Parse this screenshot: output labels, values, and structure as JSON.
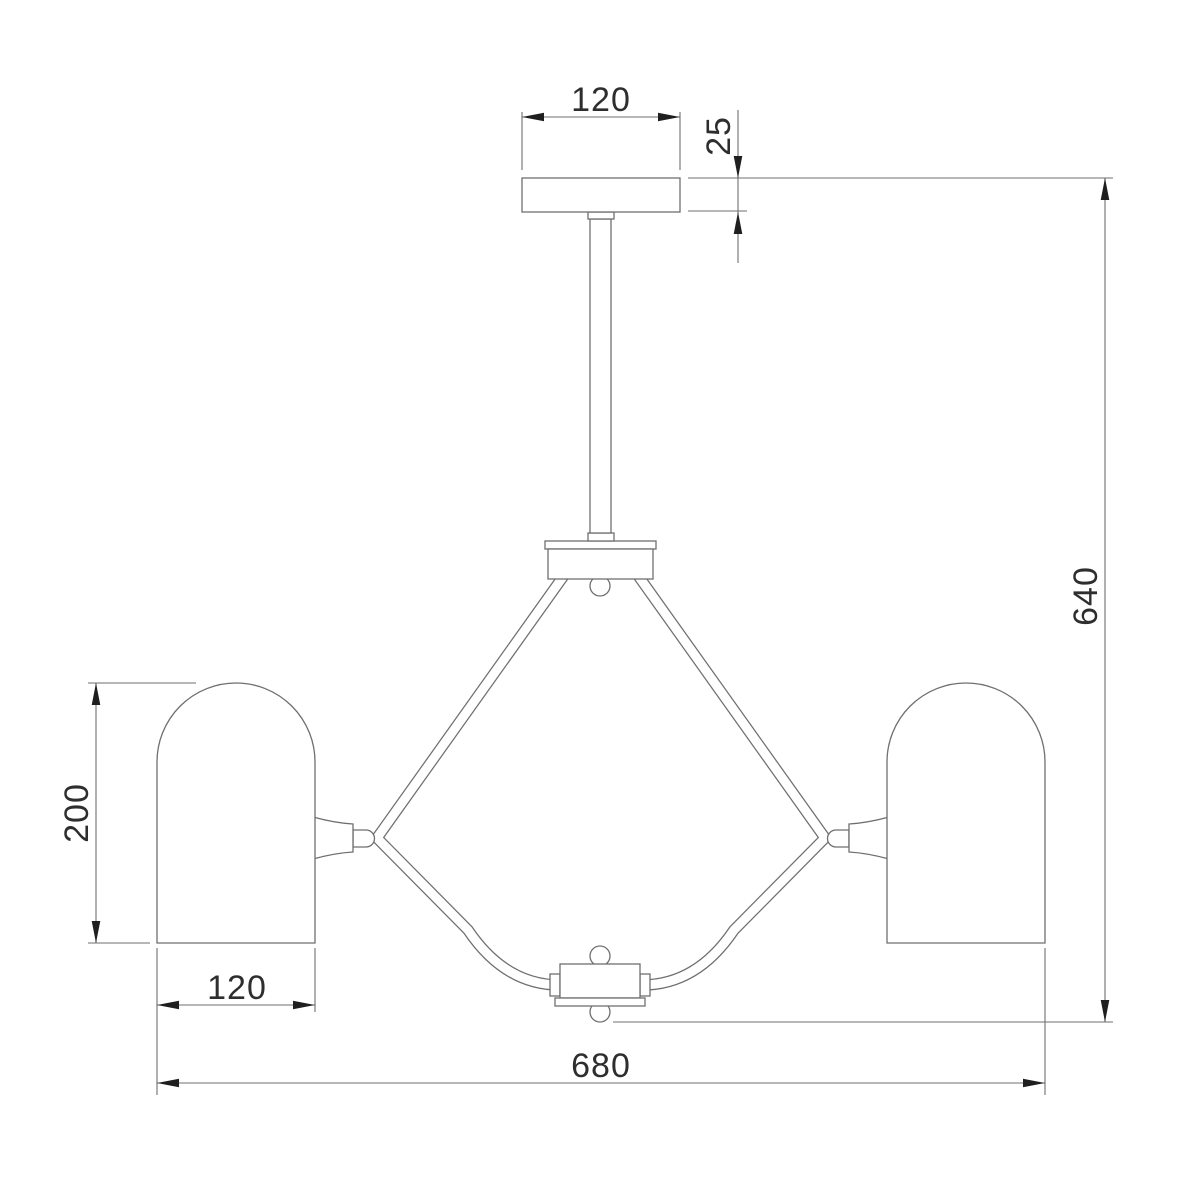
{
  "drawing": {
    "kind": "lamp-dimension-drawing",
    "dimensions": {
      "canopy_width": "120",
      "canopy_thickness": "25",
      "overall_height": "640",
      "shade_height": "200",
      "shade_width": "120",
      "overall_width": "680"
    },
    "colors": {
      "background": "#ffffff",
      "outline": "#6f6f6f",
      "dimension_line": "#6f6f6f",
      "arrow": "#1f1f1f",
      "text": "#2e2e2e"
    }
  }
}
